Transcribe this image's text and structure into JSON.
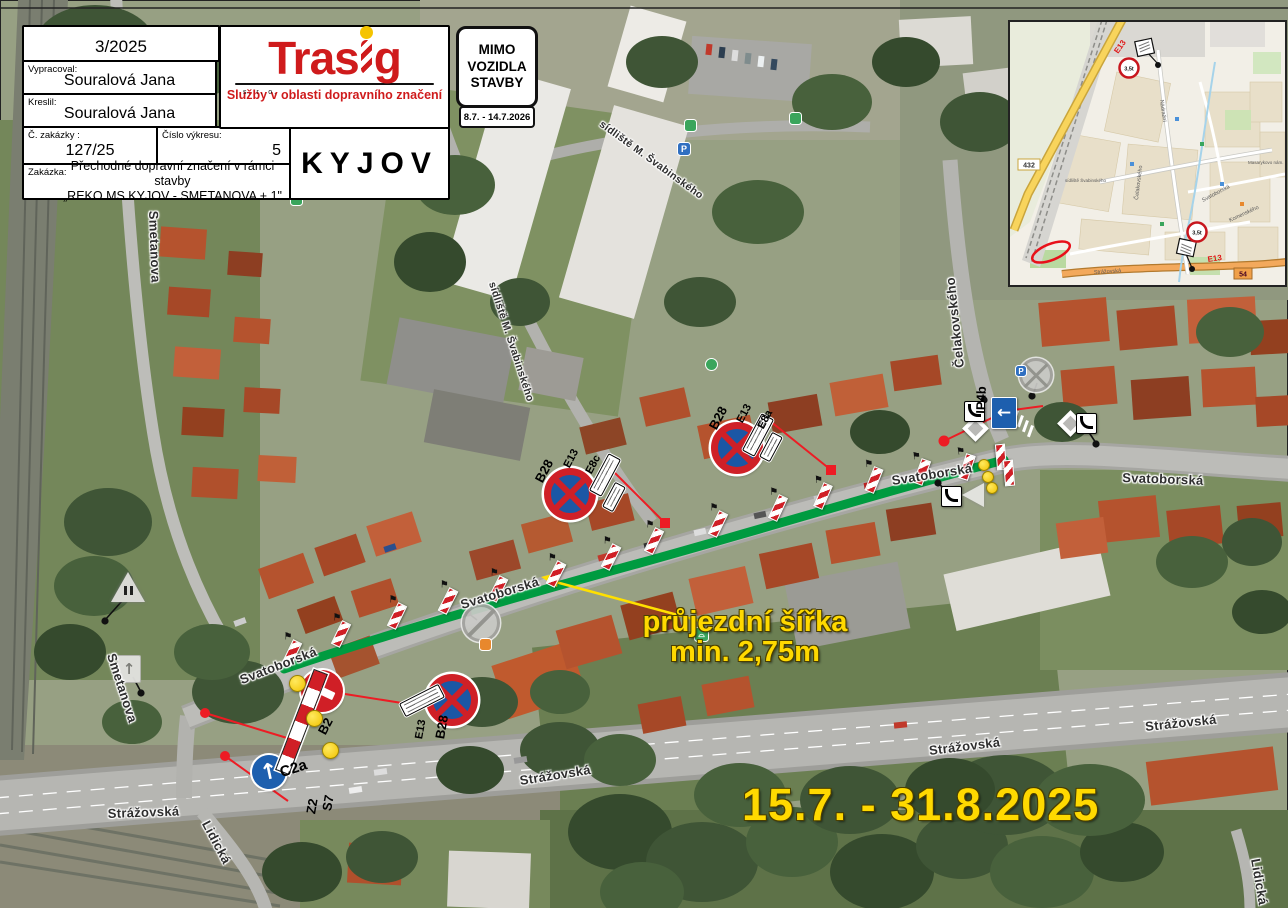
{
  "title_block": {
    "date": "3/2025",
    "vypracoval_label": "Vypracoval:",
    "vypracoval_value": "Souralová Jana",
    "kreslil_label": "Kreslil:",
    "kreslil_value": "Souralová Jana",
    "zakazky_label": "Č. zakázky :",
    "zakazky_value": "127/25",
    "vykres_label": "Číslo výkresu:",
    "vykres_value": "5",
    "zakazka_label": "Zakázka:",
    "zakazka_line1": "Přechodné dopravní značení v rámci stavby",
    "zakazka_line2": "„REKO MS KYJOV - SMETANOVA + 1\"",
    "city": "KYJOV"
  },
  "logo": {
    "part1": "Tras",
    "part2": "g",
    "suffix": "s. r. o.",
    "tagline": "Služby v oblasti dopravního značení"
  },
  "mimo_sign": {
    "line1": "MIMO",
    "line2": "VOZIDLA",
    "line3": "STAVBY",
    "dates": "8.7. - 14.7.2026"
  },
  "annotations": {
    "clearance_line1": "průjezdní šířka",
    "clearance_line2": "min. 2,75m",
    "period": "15.7. - 31.8.2025"
  },
  "street_labels": [
    {
      "text": "Smetanova"
    },
    {
      "text": "Smetanova"
    },
    {
      "text": "sídliště M. Švabinského"
    },
    {
      "text": "sídliště M. Švabinského"
    },
    {
      "text": "Čelakovského"
    },
    {
      "text": "Svatoborská"
    },
    {
      "text": "Svatoborská"
    },
    {
      "text": "Svatoborská"
    },
    {
      "text": "Svatoborská"
    },
    {
      "text": "Strážovská"
    },
    {
      "text": "Strážovská"
    },
    {
      "text": "Strážovská"
    },
    {
      "text": "Strážovská"
    },
    {
      "text": "Lidická"
    },
    {
      "text": "Lidická"
    }
  ],
  "sign_labels": [
    {
      "text": "B28"
    },
    {
      "text": "E13"
    },
    {
      "text": "E8c"
    },
    {
      "text": "B28"
    },
    {
      "text": "E13"
    },
    {
      "text": "E8a"
    },
    {
      "text": "B28"
    },
    {
      "text": "E13"
    },
    {
      "text": "B2"
    },
    {
      "text": "C2a"
    },
    {
      "text": "Z2"
    },
    {
      "text": "S7"
    },
    {
      "text": "IP4b"
    }
  ],
  "inset": {
    "shield_432": "432",
    "shield_54": "54",
    "weight": "3,5t",
    "e13": "E13",
    "labels": [
      {
        "text": "Nádražní"
      },
      {
        "text": "Čelakovského"
      },
      {
        "text": "sídliště Švabinského"
      },
      {
        "text": "Svatoborská"
      },
      {
        "text": "Komenského"
      },
      {
        "text": "Strážovská"
      },
      {
        "text": "Masarykovo nám."
      }
    ]
  },
  "colors": {
    "route_green": "#009b40",
    "leader_red": "#ed1c24",
    "annotation_yellow": "#ffe01a",
    "brand_red": "#cf1b1c",
    "sign_blue": "#1b57a5"
  }
}
